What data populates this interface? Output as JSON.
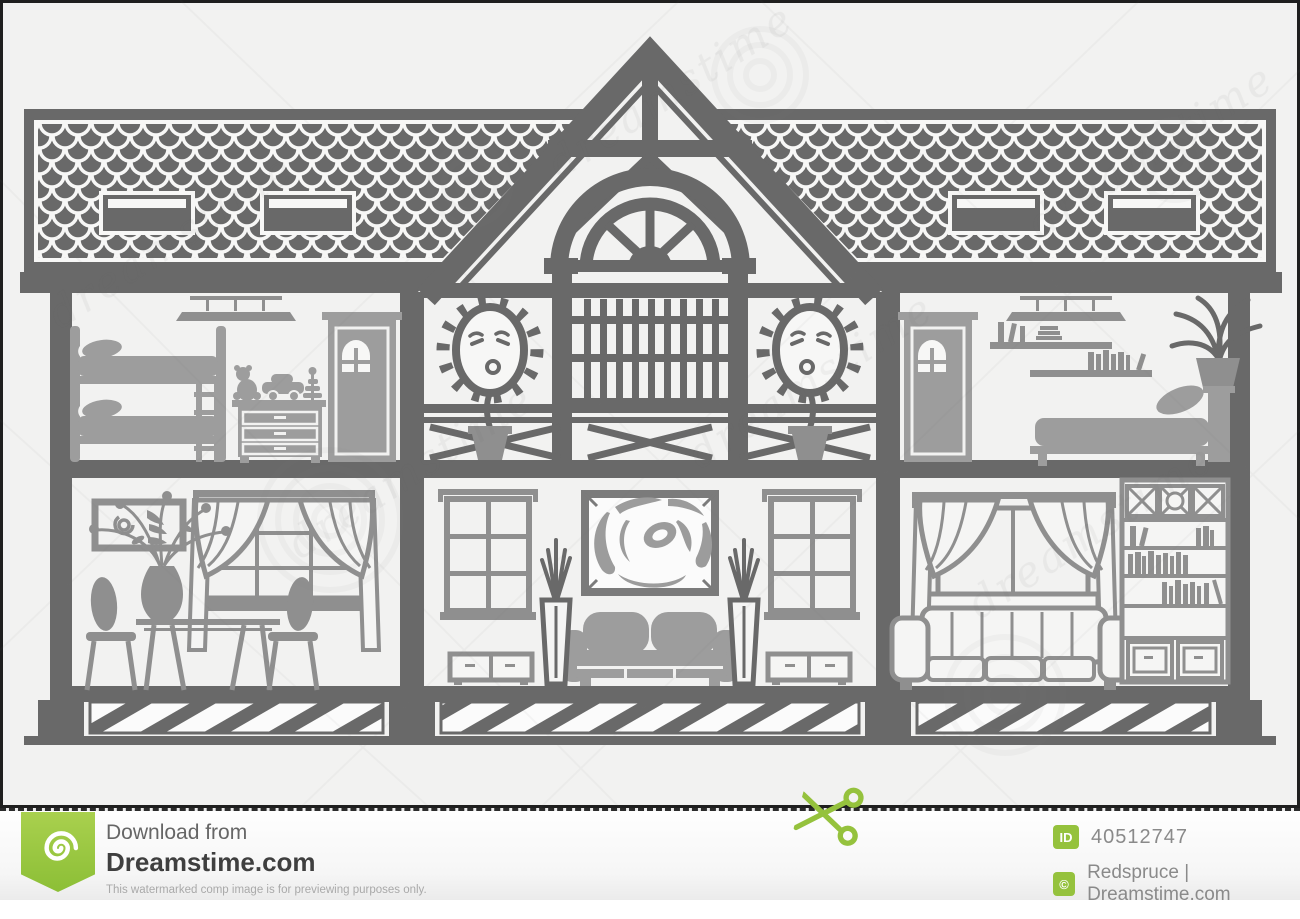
{
  "image": {
    "watermark_text": "dreamstime",
    "subject": "house cross-section silhouette with furnished rooms"
  },
  "colors": {
    "background": "#f2f2f1",
    "structure_dark": "#696969",
    "furniture_mid": "#8f8f8f",
    "furniture_light": "#9d9d9d",
    "frame_border": "#1f1f1f",
    "accent_green": "#95c23d",
    "text_dark": "#3f3f3f",
    "text_gray": "#8a8a8a",
    "text_light": "#a9a9a9"
  },
  "icons": {
    "ribbon_logo": "dreamstime-spiral-icon",
    "cut_line": "scissors-icon",
    "id_badge": "id-badge-icon",
    "copyright_badge": "copyright-badge-icon"
  },
  "footer": {
    "download_label": "Download from",
    "site_name": "Dreamstime.com",
    "disclaimer": "This watermarked comp image is for previewing purposes only.",
    "id_badge_label": "ID",
    "image_id": "40512747",
    "copyright_symbol": "©",
    "credit": "Redspruce | Dreamstime.com"
  }
}
